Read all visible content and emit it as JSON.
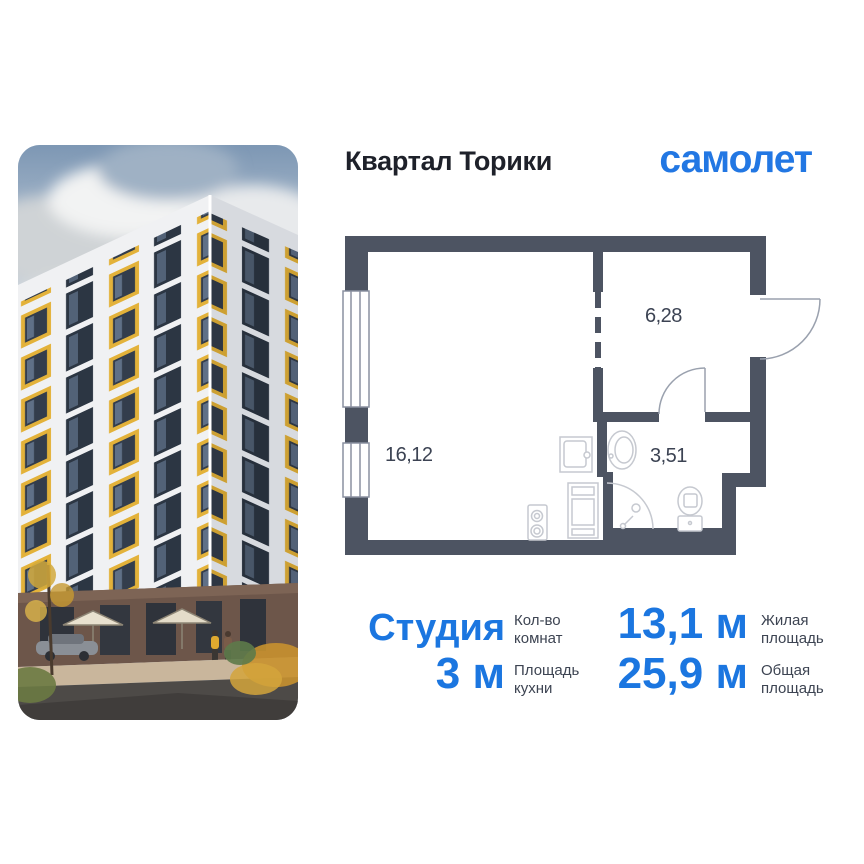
{
  "header": {
    "title": "Квартал Торики",
    "brand": "самолет"
  },
  "plan": {
    "living_area": "16,12",
    "hall_area": "6,28",
    "bath_area": "3,51"
  },
  "specs": {
    "rooms": {
      "value": "Студия",
      "label": "Кол-во комнат"
    },
    "living": {
      "value": "13,1 м",
      "label": "Жилая площадь"
    },
    "kitchen": {
      "value": "3 м",
      "label": "Площадь кухни"
    },
    "total": {
      "value": "25,9 м",
      "label": "Общая площадь"
    }
  },
  "colors": {
    "accent_blue": "#1b76e0",
    "logo_blue": "#2277e3",
    "wall_dark": "#4d5462",
    "label_gray": "#3d4452",
    "facade_yellow": "#e3b23a"
  }
}
